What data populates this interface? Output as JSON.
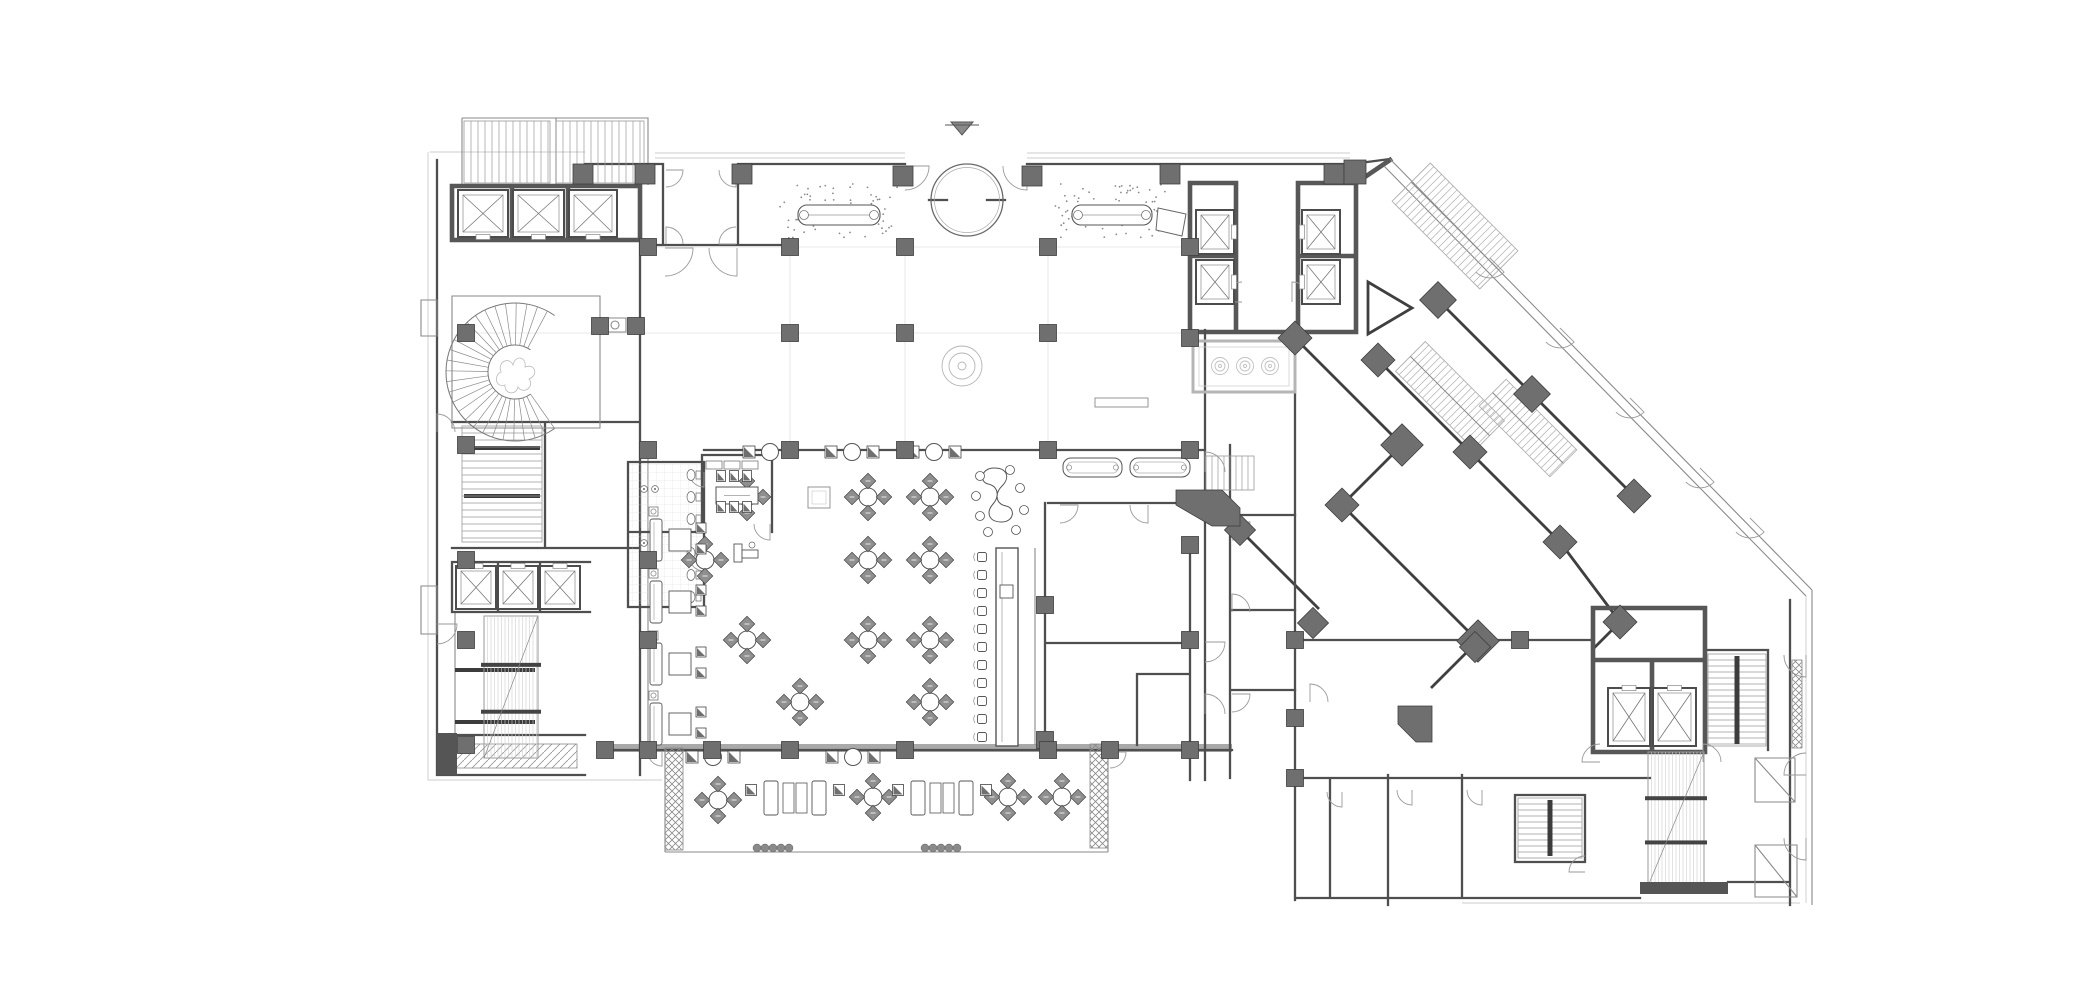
{
  "sheet": {
    "width": 2075,
    "height": 1007,
    "background": "#ffffff",
    "drawing_type": "hotel-ground-floor-plan"
  },
  "palette": {
    "ink": "#3f3f3f",
    "wall": "#4f4f4f",
    "poche": "#6f6f6f",
    "medium": "#8a8a8a",
    "light": "#b5b5b5",
    "faint": "#d9d9d9",
    "paper": "#ffffff"
  },
  "symbols": {
    "north_arrow_icon": "down-pointing solid arrow above entrance",
    "elevator_icon": "rectangle with X diagonals",
    "door_icon": "quarter-circle swing arc",
    "stair_icon": "parallel tread lines",
    "escalator_icon": "paired tread rails with landing bars",
    "column_icon": "solid grey square",
    "diamond_column_icon": "solid grey 45deg square",
    "spiral_stair_icon": "radial fan treads",
    "planter_icon": "cross-hatched rectangle",
    "fountain_icon": "rectangle with three concentric-circle jets"
  },
  "north_arrow": {
    "x": 962,
    "y": 128
  },
  "circle_vestibule": {
    "cx": 967,
    "cy": 200,
    "r": 36
  },
  "circle_feature": {
    "cx": 962,
    "cy": 366
  },
  "fountain": {
    "rect": [
      1193,
      341,
      102,
      51
    ],
    "jets": [
      [
        1220,
        366
      ],
      [
        1245,
        366
      ],
      [
        1270,
        366
      ]
    ]
  },
  "spiral_stair": {
    "cx": 515,
    "cy": 372,
    "r0": 27,
    "r1": 69,
    "a0": 55,
    "a1": 305,
    "step": 9
  },
  "columns": [
    [
      648,
      247
    ],
    [
      790,
      247
    ],
    [
      905,
      247
    ],
    [
      1048,
      247
    ],
    [
      1190,
      247
    ],
    [
      466,
      333
    ],
    [
      600,
      326
    ],
    [
      636,
      326
    ],
    [
      790,
      333
    ],
    [
      905,
      333
    ],
    [
      1048,
      333
    ],
    [
      1190,
      338
    ],
    [
      648,
      450
    ],
    [
      790,
      450
    ],
    [
      905,
      450
    ],
    [
      1048,
      450
    ],
    [
      1190,
      450
    ],
    [
      648,
      560
    ],
    [
      1045,
      605
    ],
    [
      1190,
      545
    ],
    [
      648,
      640
    ],
    [
      1045,
      740
    ],
    [
      1190,
      640
    ],
    [
      605,
      750
    ],
    [
      648,
      750
    ],
    [
      712,
      750
    ],
    [
      790,
      750
    ],
    [
      905,
      750
    ],
    [
      1048,
      750
    ],
    [
      1110,
      750
    ],
    [
      1190,
      750
    ],
    [
      466,
      445
    ],
    [
      466,
      560
    ],
    [
      466,
      640
    ],
    [
      466,
      745
    ],
    [
      1295,
      640
    ],
    [
      1295,
      718
    ],
    [
      1295,
      778
    ],
    [
      1520,
      640
    ]
  ],
  "piers": [
    [
      583,
      174
    ],
    [
      645,
      174
    ],
    [
      742,
      174
    ],
    [
      903,
      176
    ],
    [
      1032,
      176
    ],
    [
      1170,
      174
    ],
    [
      1334,
      174
    ]
  ],
  "diamond_columns": [
    [
      1295,
      338,
      24
    ],
    [
      1402,
      445,
      30
    ],
    [
      1342,
      505,
      24
    ],
    [
      1478,
      641,
      30
    ],
    [
      1438,
      300,
      26
    ],
    [
      1532,
      394,
      26
    ],
    [
      1634,
      496,
      24
    ],
    [
      1378,
      360,
      24
    ],
    [
      1470,
      452,
      24
    ],
    [
      1560,
      542,
      24
    ],
    [
      1620,
      622,
      24
    ],
    [
      1240,
      530,
      22
    ],
    [
      1313,
      623,
      22
    ],
    [
      1475,
      647,
      22
    ]
  ],
  "elevator_shafts": [
    [
      458,
      190,
      50,
      47,
      "b"
    ],
    [
      513,
      190,
      51,
      47,
      "b"
    ],
    [
      569,
      190,
      48,
      47,
      "b"
    ],
    [
      456,
      566,
      40,
      43,
      "t"
    ],
    [
      498,
      566,
      40,
      43,
      "t"
    ],
    [
      540,
      566,
      40,
      43,
      "t"
    ],
    [
      1196,
      210,
      38,
      44,
      "r"
    ],
    [
      1196,
      260,
      38,
      44,
      "r"
    ],
    [
      1302,
      210,
      38,
      44,
      "l"
    ],
    [
      1302,
      260,
      38,
      44,
      "l"
    ],
    [
      1608,
      688,
      42,
      58,
      "t"
    ],
    [
      1653,
      688,
      43,
      58,
      "t"
    ]
  ],
  "stairs_linear": [
    {
      "x": 464,
      "y": 121,
      "w": 86,
      "h": 62,
      "dir": "v",
      "step": 7
    },
    {
      "x": 556,
      "y": 121,
      "w": 88,
      "h": 62,
      "dir": "v",
      "step": 7
    },
    {
      "x": 462,
      "y": 426,
      "w": 80,
      "h": 116,
      "dir": "h",
      "step": 7,
      "bars": [
        448,
        495
      ]
    },
    {
      "x": 1206,
      "y": 456,
      "w": 48,
      "h": 34,
      "dir": "v",
      "step": 6
    },
    {
      "x": 1518,
      "y": 798,
      "w": 64,
      "h": 60,
      "dir": "h",
      "step": 6,
      "rail": true
    },
    {
      "x": 1708,
      "y": 654,
      "w": 58,
      "h": 92,
      "dir": "h",
      "step": 6,
      "rail": true
    }
  ],
  "stairs_rotated": [
    {
      "cx": 1455,
      "cy": 226,
      "w": 124,
      "h": 54,
      "a": 45
    },
    {
      "cx": 1450,
      "cy": 396,
      "w": 112,
      "h": 42,
      "a": 45
    },
    {
      "cx": 1528,
      "cy": 428,
      "w": 100,
      "h": 38,
      "a": 45
    }
  ],
  "escalators": [
    {
      "x": 484,
      "y": 616,
      "w": 54,
      "h": 142
    },
    {
      "x": 1648,
      "y": 752,
      "w": 56,
      "h": 134
    }
  ],
  "door_arcs": [
    [
      666,
      170,
      17,
      0,
      90
    ],
    [
      736,
      170,
      17,
      90,
      180
    ],
    [
      666,
      244,
      17,
      270,
      360
    ],
    [
      736,
      244,
      17,
      180,
      270
    ],
    [
      665,
      248,
      28,
      0,
      90
    ],
    [
      737,
      248,
      28,
      90,
      180
    ],
    [
      905,
      166,
      24,
      0,
      90
    ],
    [
      1027,
      166,
      24,
      90,
      180
    ],
    [
      1242,
      302,
      20,
      180,
      270
    ],
    [
      1292,
      302,
      20,
      270,
      360
    ],
    [
      437,
      432,
      18,
      270,
      360
    ],
    [
      437,
      624,
      20,
      0,
      90
    ],
    [
      704,
      472,
      15,
      90,
      180
    ],
    [
      704,
      556,
      15,
      90,
      180
    ],
    [
      770,
      524,
      16,
      90,
      180
    ],
    [
      1205,
      472,
      20,
      270,
      360
    ],
    [
      1205,
      642,
      20,
      0,
      90
    ],
    [
      1205,
      714,
      20,
      270,
      360
    ],
    [
      1060,
      505,
      18,
      0,
      90
    ],
    [
      1148,
      505,
      18,
      90,
      180
    ],
    [
      1110,
      752,
      16,
      0,
      90
    ],
    [
      662,
      752,
      14,
      90,
      180
    ],
    [
      1490,
      258,
      20,
      45,
      135
    ],
    [
      1560,
      328,
      20,
      45,
      135
    ],
    [
      1630,
      398,
      20,
      45,
      135
    ],
    [
      1700,
      468,
      20,
      45,
      135
    ],
    [
      1750,
      518,
      20,
      45,
      135
    ],
    [
      1806,
      655,
      22,
      90,
      180
    ],
    [
      1806,
      775,
      22,
      180,
      270
    ],
    [
      1806,
      838,
      22,
      90,
      180
    ],
    [
      1310,
      702,
      18,
      270,
      360
    ],
    [
      1342,
      792,
      15,
      90,
      180
    ],
    [
      1412,
      790,
      15,
      90,
      180
    ],
    [
      1482,
      790,
      15,
      90,
      180
    ],
    [
      1600,
      762,
      18,
      180,
      270
    ],
    [
      1703,
      762,
      18,
      270,
      360
    ],
    [
      1585,
      872,
      16,
      180,
      270
    ],
    [
      1232,
      522,
      18,
      0,
      90
    ],
    [
      1232,
      612,
      18,
      270,
      360
    ],
    [
      1232,
      694,
      18,
      0,
      90
    ]
  ],
  "round_tables_4": [
    [
      747,
      497
    ],
    [
      705,
      560
    ],
    [
      747,
      640
    ],
    [
      868,
      497
    ],
    [
      930,
      497
    ],
    [
      868,
      560
    ],
    [
      930,
      560
    ],
    [
      868,
      640
    ],
    [
      930,
      640
    ],
    [
      800,
      702
    ],
    [
      930,
      702
    ],
    [
      718,
      800
    ],
    [
      873,
      797
    ],
    [
      1008,
      797
    ],
    [
      1062,
      797
    ]
  ],
  "banquette_groups": [
    [
      770,
      452
    ],
    [
      852,
      452
    ],
    [
      934,
      452
    ],
    [
      713,
      757
    ],
    [
      853,
      757
    ]
  ],
  "lounge_units": [
    [
      676,
      540
    ],
    [
      676,
      602
    ],
    [
      676,
      664
    ],
    [
      676,
      724
    ]
  ],
  "terrace_lounges": [
    [
      795,
      798
    ],
    [
      942,
      798
    ]
  ],
  "communal_table": {
    "x": 1002,
    "y": 502
  },
  "bar": {
    "counter": [
      996,
      548,
      22,
      198
    ],
    "stool_x": 982,
    "stool_ys": [
      557,
      575,
      593,
      611,
      629,
      647,
      665,
      683,
      701,
      719,
      737
    ],
    "counter_box": [
      1000,
      585,
      13,
      13
    ]
  },
  "private_dining": {
    "table": [
      716,
      487,
      42,
      17
    ],
    "chairs": [
      [
        721,
        476
      ],
      [
        734,
        476
      ],
      [
        747,
        476
      ],
      [
        721,
        507
      ],
      [
        734,
        507
      ],
      [
        747,
        507
      ]
    ],
    "cabinets": [
      [
        706,
        461
      ],
      [
        724,
        461
      ],
      [
        742,
        461
      ]
    ]
  },
  "benches": [
    [
      1063,
      458,
      59,
      19
    ],
    [
      1130,
      458,
      60,
      19
    ]
  ],
  "low_table": [
    1095,
    398,
    53,
    9
  ],
  "rug": [
    808,
    487,
    22,
    21
  ],
  "reception_counters": [
    [
      798,
      205,
      82,
      20
    ],
    [
      1072,
      205,
      80,
      20
    ]
  ],
  "podium": "1158,208 1186,214 1182,236 1156,230",
  "stipple_areas": [
    [
      780,
      184,
      118,
      54,
      70
    ],
    [
      1054,
      184,
      112,
      54,
      66
    ]
  ],
  "planters": [
    [
      665,
      748,
      18,
      102
    ],
    [
      1090,
      744,
      18,
      104
    ],
    [
      1792,
      660,
      10,
      88
    ]
  ],
  "shrub_rows": [
    [
      757,
      848,
      5,
      8
    ],
    [
      925,
      848,
      5,
      8
    ]
  ],
  "toilets": [
    [
      693,
      475
    ],
    [
      693,
      497
    ],
    [
      693,
      519
    ],
    [
      693,
      553
    ],
    [
      693,
      575
    ],
    [
      693,
      597
    ]
  ],
  "sinks": [
    [
      644,
      489
    ],
    [
      655,
      489
    ],
    [
      644,
      543
    ],
    [
      655,
      543
    ]
  ],
  "corner_piers": [
    "1176,490 1222,490 1240,508 1240,526 1212,526 1176,505",
    "1398,706 1432,706 1432,742 1416,742 1398,724",
    "1344,160 1366,160 1366,184 1344,184"
  ],
  "landing_bars": [
    [
      464,
      446,
      76,
      4
    ],
    [
      464,
      494,
      76,
      4
    ],
    [
      455,
      668,
      80,
      4
    ],
    [
      455,
      720,
      80,
      4
    ]
  ],
  "dark_bands": [
    [
      1640,
      882,
      88,
      12
    ],
    [
      437,
      733,
      20,
      42
    ]
  ]
}
